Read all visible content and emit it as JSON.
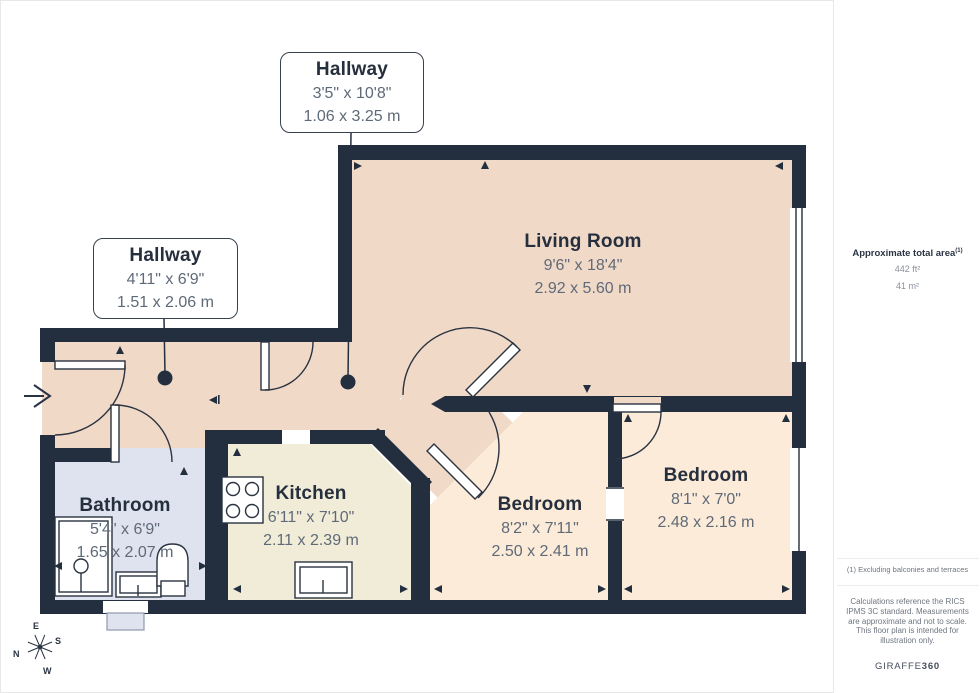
{
  "palette": {
    "wall": "#232e3e",
    "floor_hall_living": "#f1d9c8",
    "floor_bedroom": "#fcebd8",
    "floor_kitchen": "#f1ecd8",
    "floor_bathroom": "#dee3ef",
    "room_name_text": "#262f3d",
    "dimension_text": "#5f6a78"
  },
  "rooms": {
    "hallway_top": {
      "name": "Hallway",
      "imperial": "3'5\" x 10'8\"",
      "metric": "1.06 x 3.25 m"
    },
    "hallway_left": {
      "name": "Hallway",
      "imperial": "4'11\" x 6'9\"",
      "metric": "1.51 x 2.06 m"
    },
    "living_room": {
      "name": "Living Room",
      "imperial": "9'6\" x 18'4\"",
      "metric": "2.92 x 5.60 m"
    },
    "bathroom": {
      "name": "Bathroom",
      "imperial": "5'4\" x 6'9\"",
      "metric": "1.65 x 2.07 m"
    },
    "kitchen": {
      "name": "Kitchen",
      "imperial": "6'11\" x 7'10\"",
      "metric": "2.11 x 2.39 m"
    },
    "bedroom_middle": {
      "name": "Bedroom",
      "imperial": "8'2\" x 7'11\"",
      "metric": "2.50 x 2.41 m"
    },
    "bedroom_right": {
      "name": "Bedroom",
      "imperial": "8'1\" x 7'0\"",
      "metric": "2.48 x 2.16 m"
    }
  },
  "sidebar": {
    "area_title": "Approximate total area",
    "area_note_marker": "(1)",
    "area_imperial": "442 ft²",
    "area_metric": "41 m²",
    "footnote": "(1) Excluding balconies and terraces",
    "disclaimer": "Calculations reference the RICS IPMS 3C standard. Measurements are approximate and not to scale. This floor plan is intended for illustration only.",
    "brand_name": "GIRAFFE",
    "brand_suffix": "360"
  },
  "compass": {
    "north": "N",
    "east": "E",
    "south": "S",
    "west": "W"
  }
}
